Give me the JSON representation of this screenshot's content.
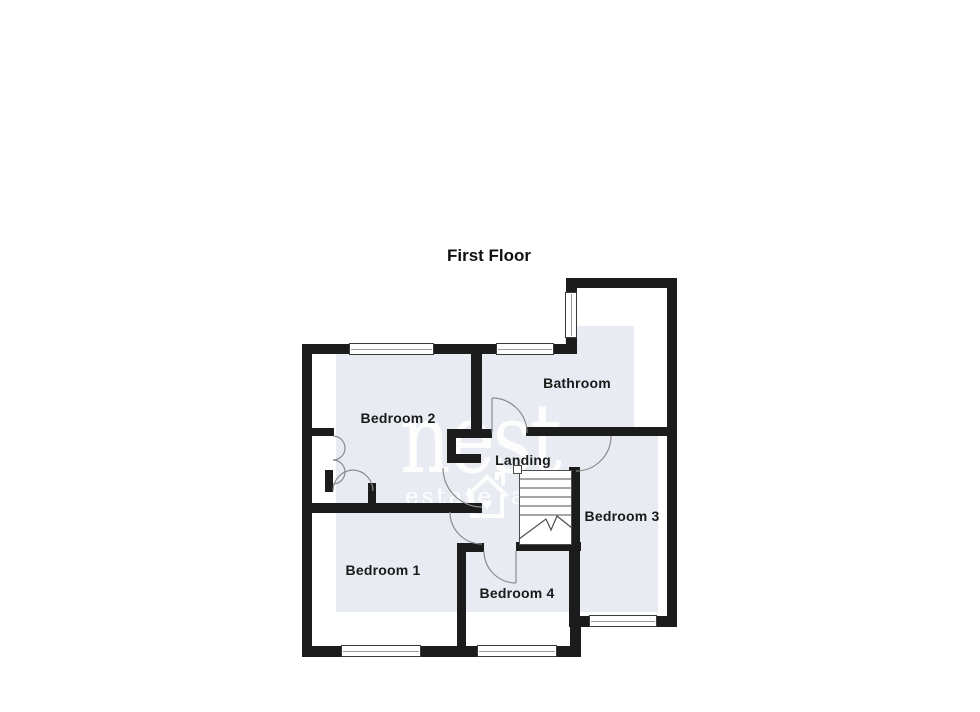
{
  "title": "First Floor",
  "rooms": {
    "bathroom": "Bathroom",
    "bedroom1": "Bedroom 1",
    "bedroom2": "Bedroom 2",
    "bedroom3": "Bedroom 3",
    "bedroom4": "Bedroom 4",
    "landing": "Landing"
  },
  "watermark": {
    "brand": "nest",
    "tagline_left": "estate",
    "tagline_right": "a",
    "icon": "house-heart-icon"
  },
  "colors": {
    "wall": "#1c1c1c",
    "room_tint": "#e8ecf2",
    "label_text": "#1a1a1a",
    "watermark_text": "#ffffff"
  }
}
